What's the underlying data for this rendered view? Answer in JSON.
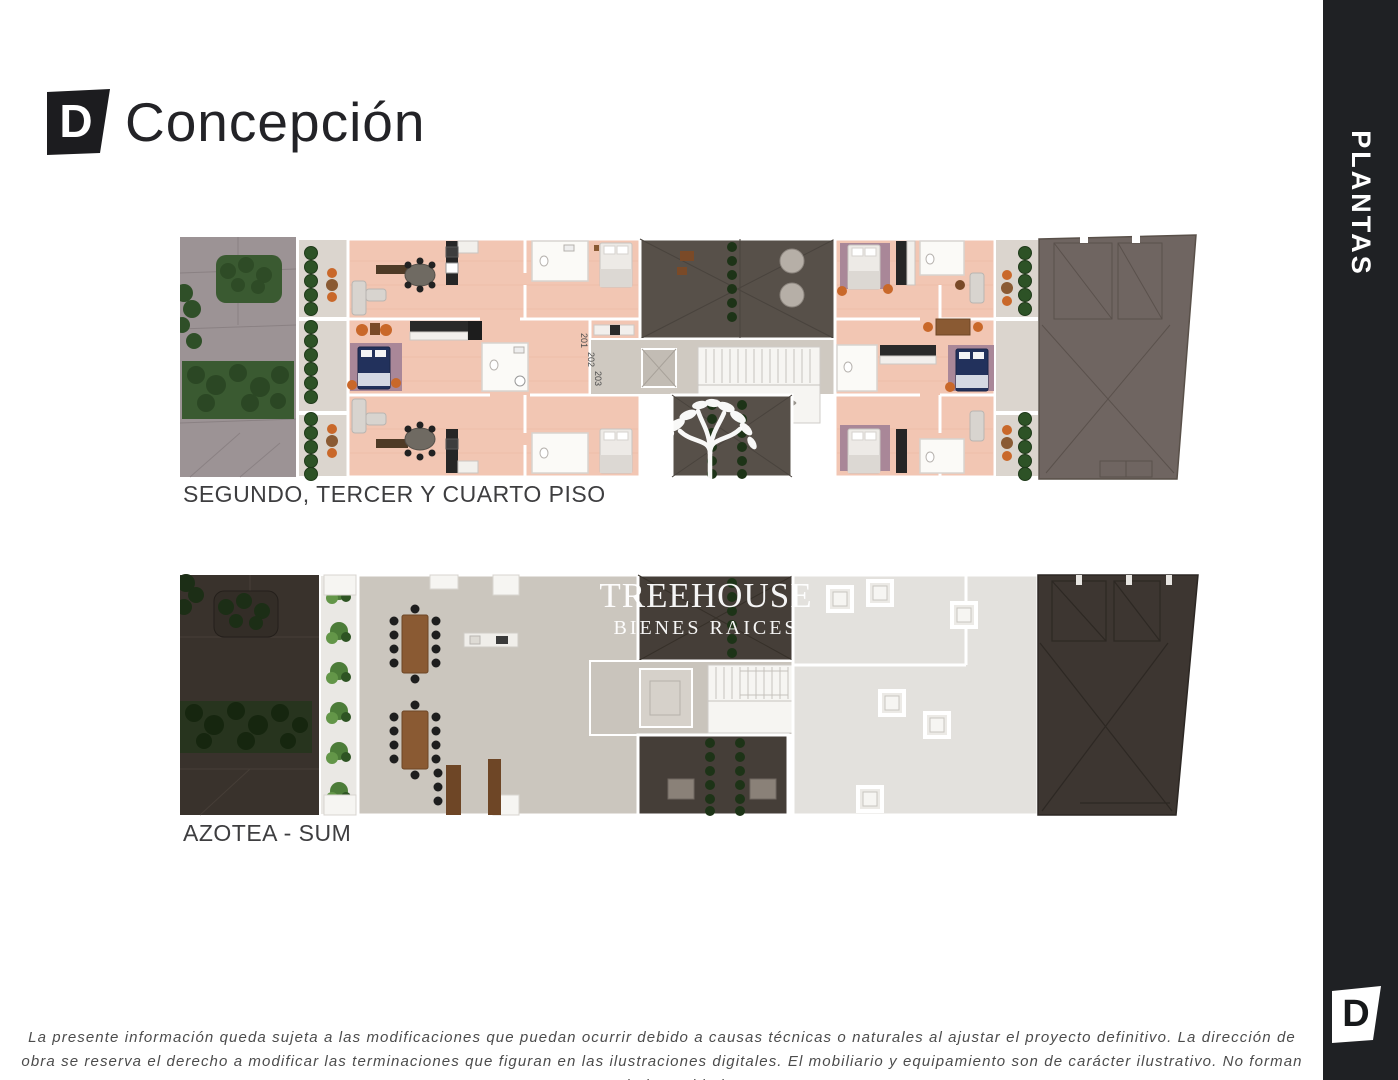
{
  "logo": {
    "mark": "D",
    "text": "Concepción"
  },
  "sidebar": {
    "label": "PLANTAS",
    "footer_mark": "D"
  },
  "plans": [
    {
      "title": "SEGUNDO, TERCER Y CUARTO PISO",
      "unit_numbers": [
        "201",
        "202",
        "203",
        "204",
        "205",
        "206"
      ]
    },
    {
      "title": "AZOTEA - SUM"
    }
  ],
  "watermark": {
    "title": "TREEHOUSE",
    "subtitle": "BIENES RAICES"
  },
  "disclaimer_lines": [
    "La presente información queda sujeta a las modificaciones que puedan ocurrir debido a causas técnicas o naturales al ajustar el proyecto definitivo. La dirección de",
    "obra se reserva el derecho a modificar las terminaciones que figuran en las ilustraciones digitales. El mobiliario y equipamiento son de carácter ilustrativo. No forman",
    "parte de las unidades."
  ],
  "colors": {
    "sidebar_dark": "#1f2124",
    "floor_salmon": "#f2c6b3",
    "patio_dark": "#575049",
    "garden_gray": "#9c9395",
    "garden_dark": "#39322c",
    "terrace_gray": "#cbc6be",
    "roof_light": "#e3e1dd",
    "neighbor_roof_light": "#6f6561",
    "neighbor_roof_dark": "#3d3631",
    "plant_green": "#3a5a31",
    "plant_bright": "#4c7c38",
    "accent_orange": "#c9682a",
    "wood_brown": "#8a5a33",
    "bed_navy": "#22315c"
  }
}
